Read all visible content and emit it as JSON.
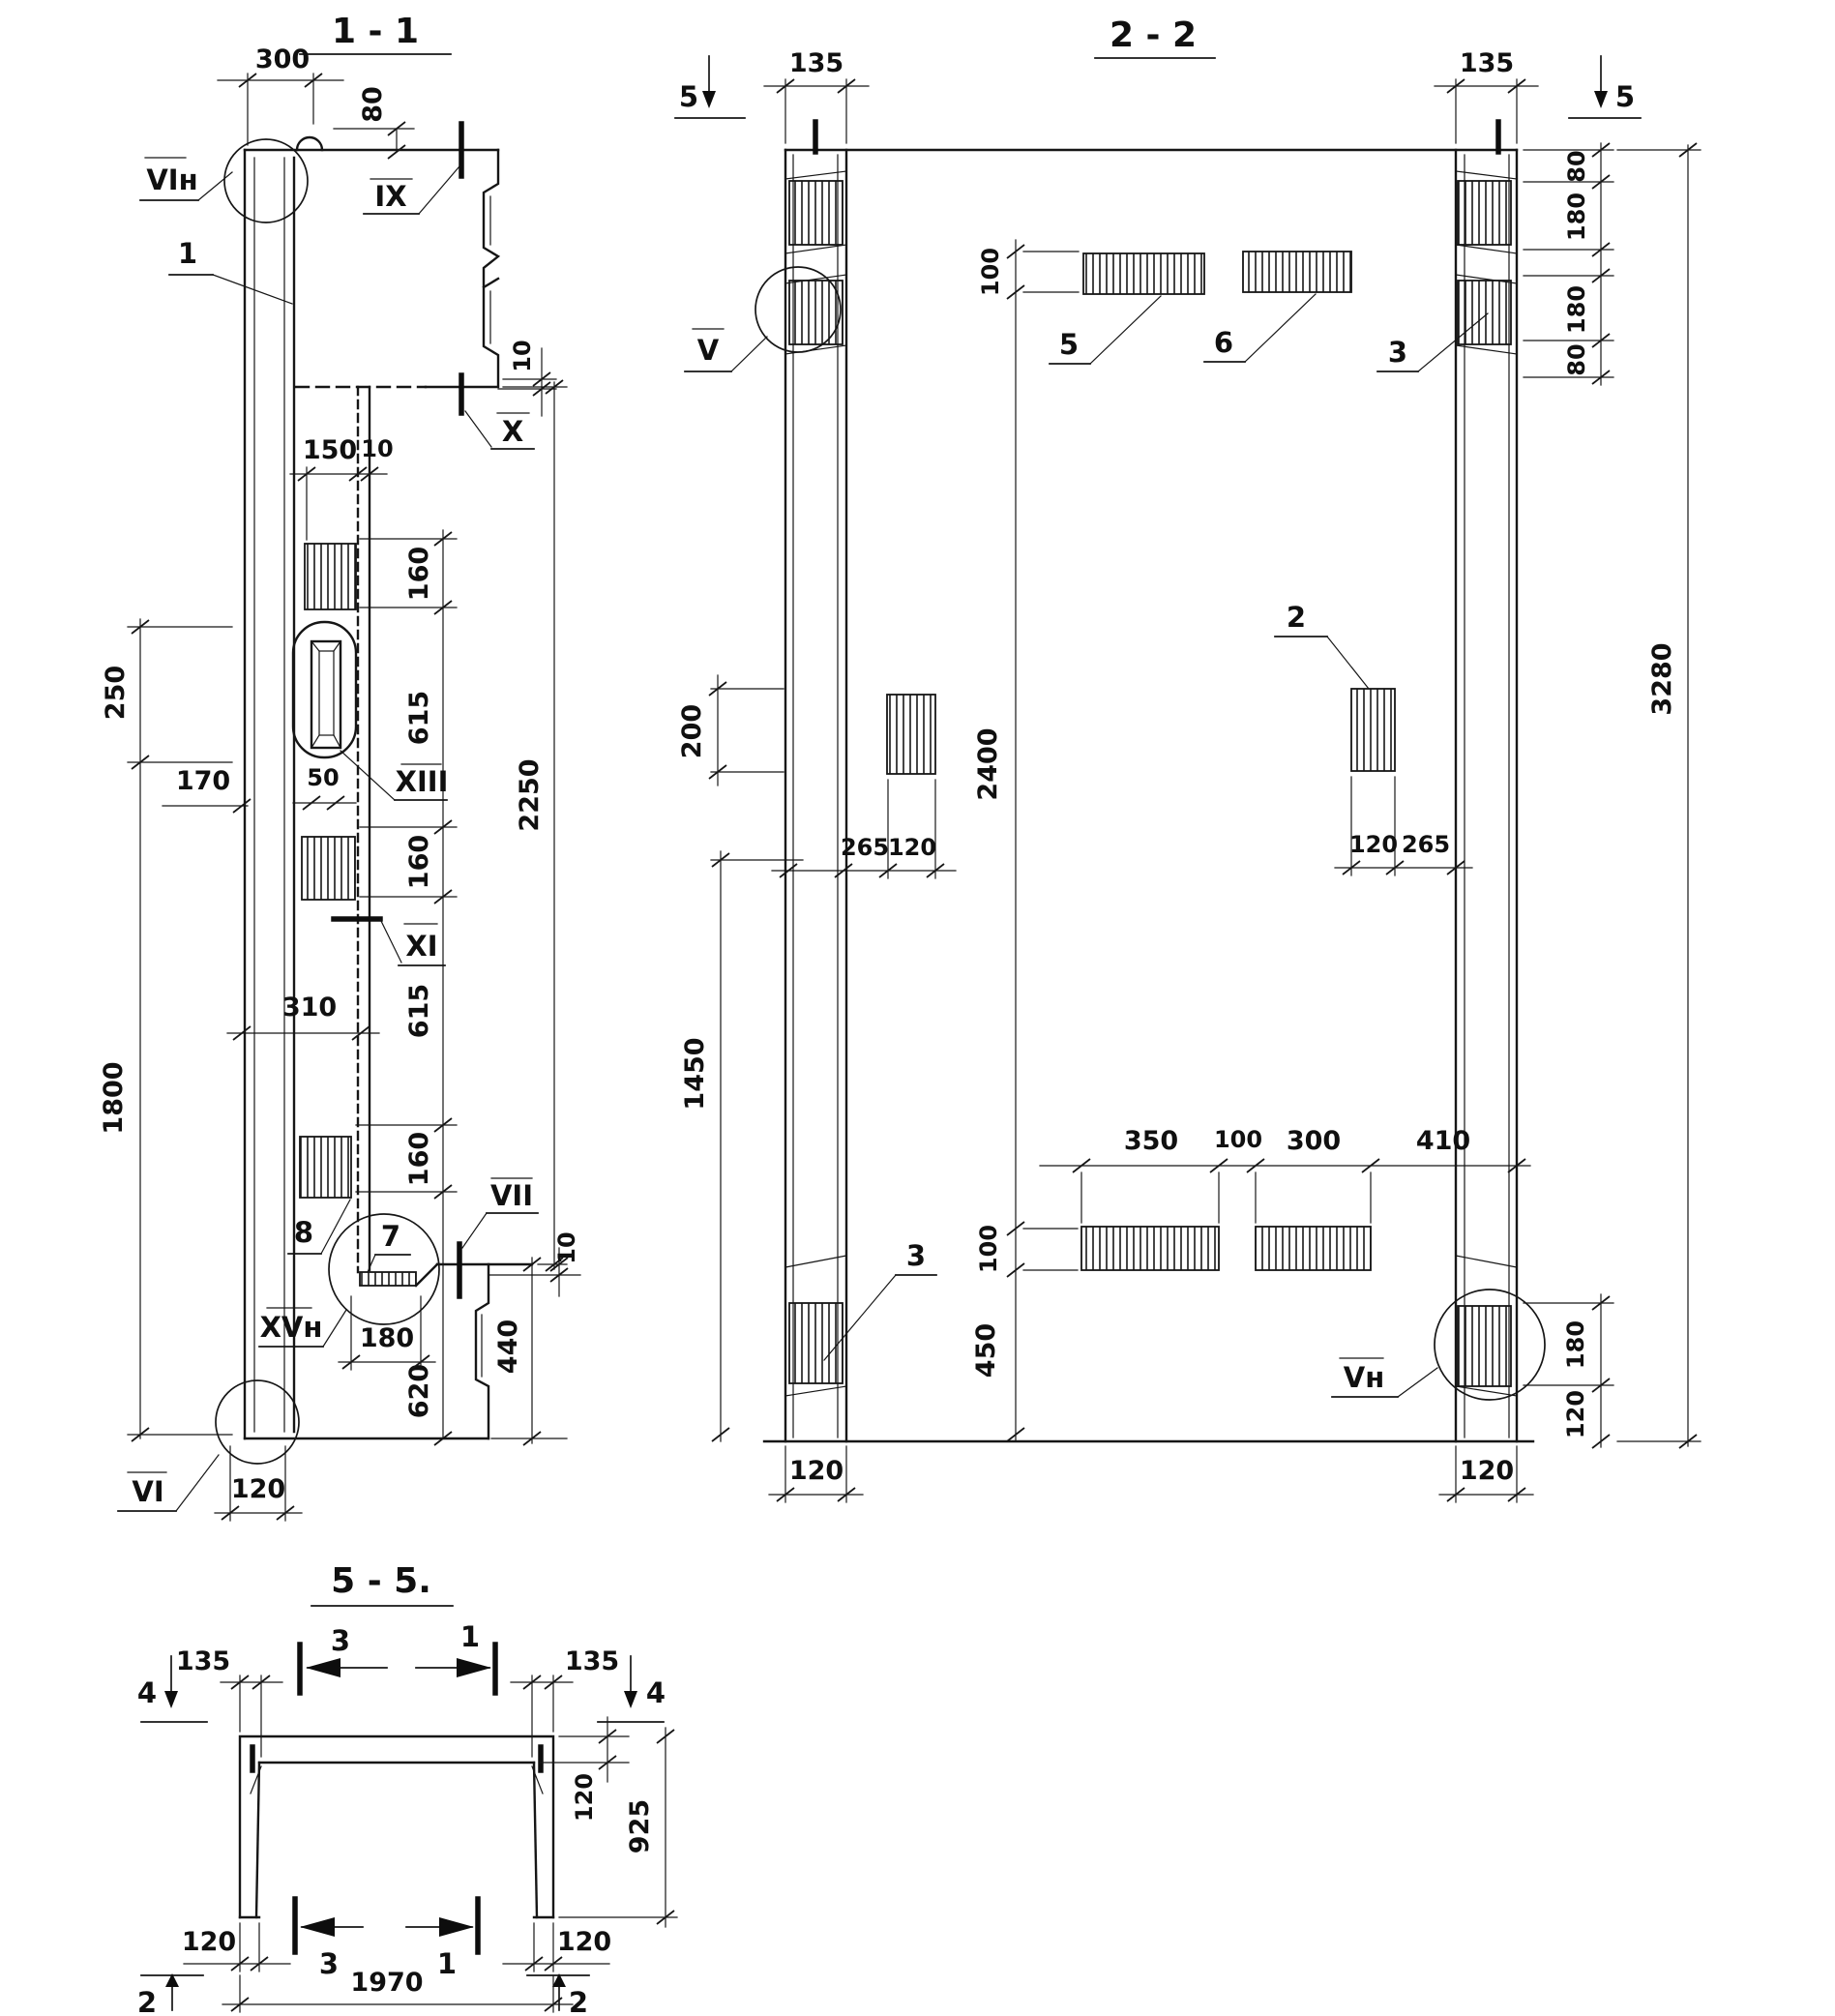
{
  "drawing": {
    "type": "structural precast panel working drawing",
    "sections": [
      "1 - 1",
      "2 - 2",
      "5 - 5."
    ]
  },
  "s11": {
    "title": "1 - 1",
    "n1": "1",
    "n7": "7",
    "n8": "8",
    "vin": "VIн",
    "ix": "IX",
    "x": "X",
    "xiii": "XIII",
    "xi": "XI",
    "vii": "VII",
    "xvn": "XVн",
    "vi": "VI",
    "d300": "300",
    "d80": "80",
    "d10": "10",
    "d150": "150",
    "d160": "160",
    "d615": "615",
    "d620": "620",
    "d2250": "2250",
    "d250": "250",
    "d170": "170",
    "d50": "50",
    "d310": "310",
    "d1800": "1800",
    "d180": "180",
    "d440": "440",
    "d120": "120"
  },
  "s22": {
    "title": "2 - 2",
    "m5": "5",
    "v": "V",
    "vn": "Vн",
    "n2": "2",
    "n3": "3",
    "n5": "5",
    "n6": "6",
    "d135": "135",
    "d80": "80",
    "d180": "180",
    "d3280": "3280",
    "d100": "100",
    "d2400": "2400",
    "d200": "200",
    "d265": "265",
    "d120": "120",
    "d1450": "1450",
    "d350": "350",
    "d300": "300",
    "d410": "410",
    "d450": "450"
  },
  "s55": {
    "title": "5 - 5.",
    "m4": "4",
    "m2": "2",
    "a3": "3",
    "a1": "1",
    "d135": "135",
    "d120": "120",
    "d925": "925",
    "d1970": "1970"
  }
}
